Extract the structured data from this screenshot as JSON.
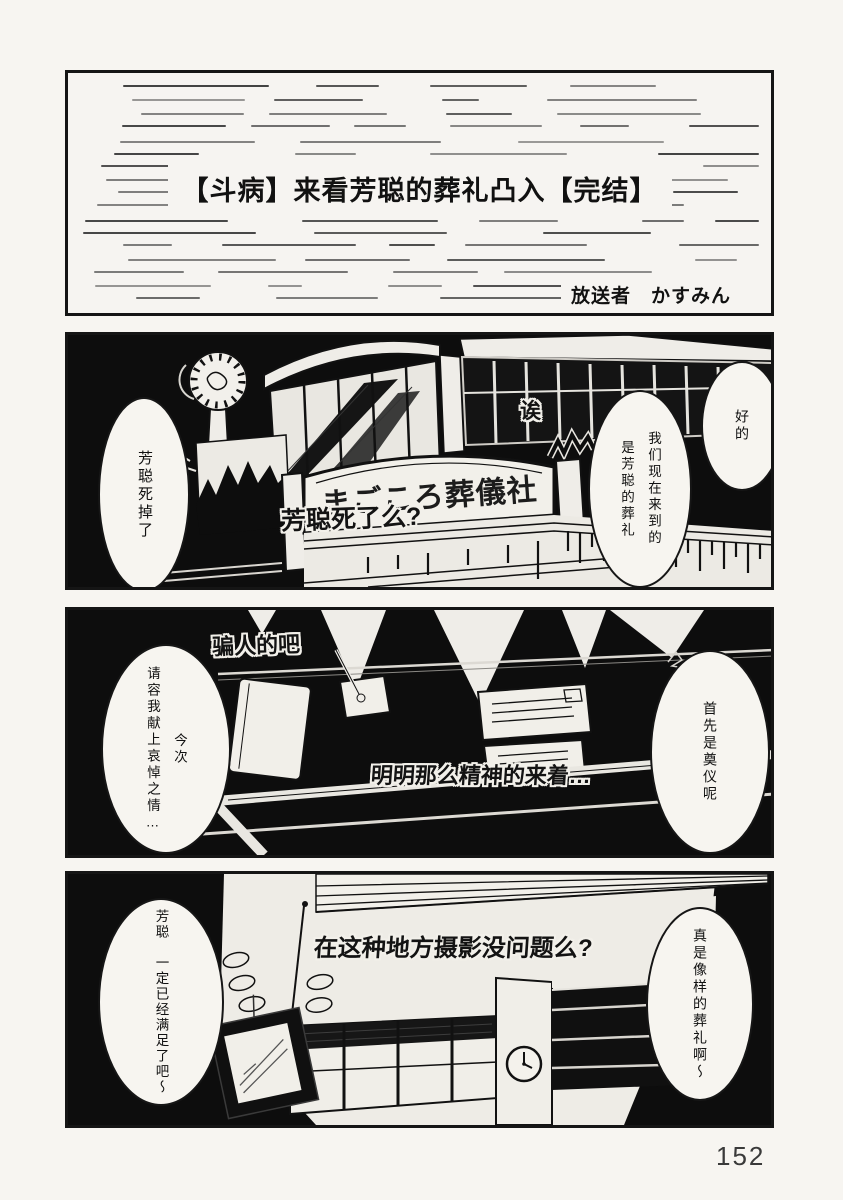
{
  "colors": {
    "paper": "#f6f4f1",
    "ink": "#111111",
    "panel_background": "#0d0d0d"
  },
  "page_number": "152",
  "title_panel": {
    "title": "【斗病】来看芳聪的葬礼凸入【完结】",
    "byline": "放送者　かすみん"
  },
  "panel_exterior": {
    "sign": "まごころ葬儀社",
    "sfx_eh": "诶",
    "sfx_question": "芳聪死了么?",
    "bubble_left": "芳聪死掉了",
    "bubble_mid": "我们现在来到的\n是芳聪的葬礼",
    "bubble_right": "好的"
  },
  "panel_reception": {
    "sfx_liar": "骗人的吧",
    "sfx_energetic": "明明那么精神的来着…",
    "bubble_left": "今次\n请容我献上哀悼之情…",
    "bubble_right": "首先是奠仪呢"
  },
  "panel_interior": {
    "sfx_filming": "在这种地方摄影没问题么?",
    "bubble_left": "芳聪　一定已经满足了吧～",
    "bubble_right": "真是像样的葬礼啊～"
  }
}
